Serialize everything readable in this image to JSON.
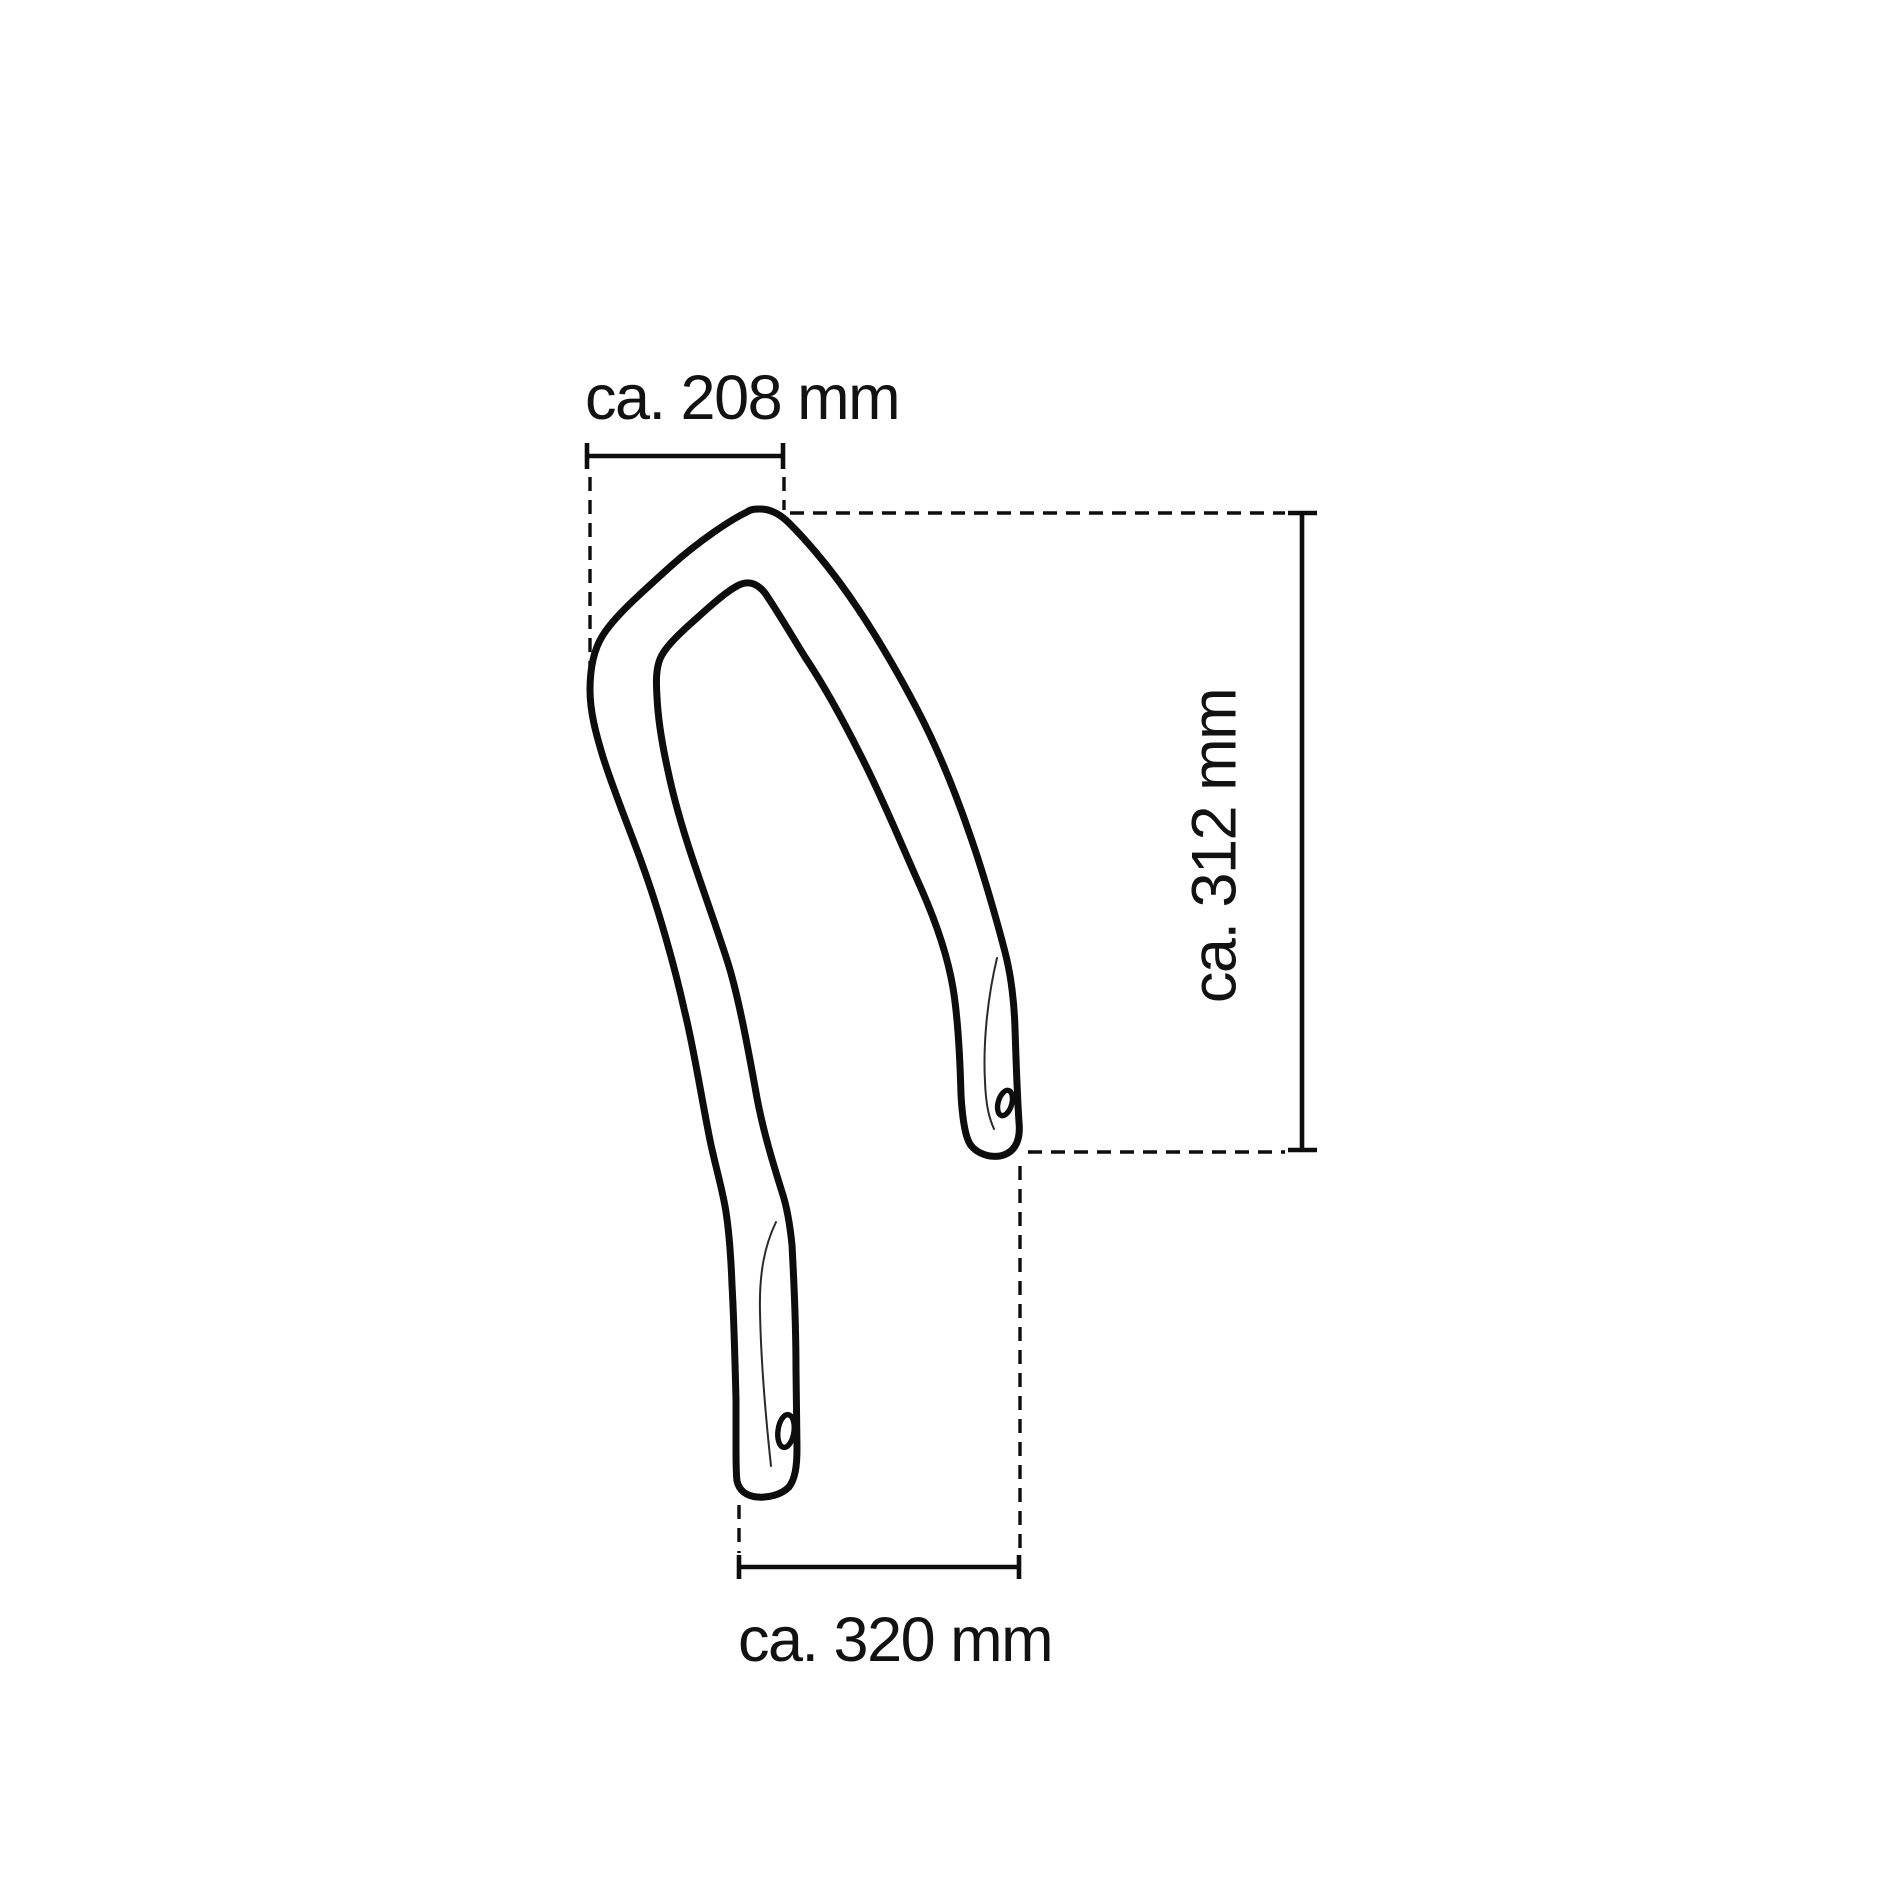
{
  "canvas": {
    "background": "#ffffff",
    "line_color": "#0d0d0d",
    "text_color": "#121212"
  },
  "drawing": {
    "kind": "technical dimension drawing",
    "labels": {
      "top_width": "ca. 208 mm",
      "right_height": "ca. 312 mm",
      "bottom_width": "ca. 320 mm"
    }
  }
}
